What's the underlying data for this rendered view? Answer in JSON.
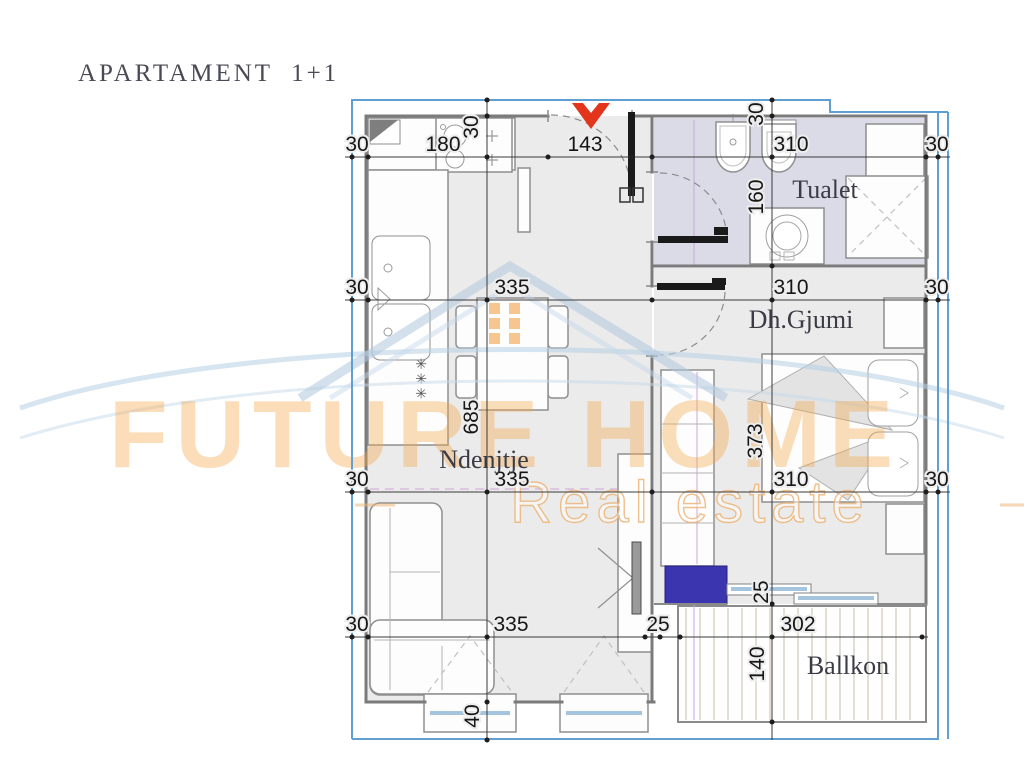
{
  "title": "APARTAMENT  1+1",
  "rooms": {
    "living": "Ndenjtje",
    "toilet": "Tualet",
    "bedroom": "Dh.Gjumi",
    "balcony": "Ballkon"
  },
  "watermark": {
    "brand_line1": "FUTURE HOME",
    "brand_line2": "Real estate"
  },
  "symbols": {
    "radiator": "✳✳✳"
  },
  "dims": {
    "r1_left": "30",
    "r1_kitchen": "180",
    "r1_entry": "143",
    "r1_toilet": "310",
    "r1_right": "30",
    "v_top_left": "30",
    "v_top_right": "30",
    "r2_left": "30",
    "r2_living": "335",
    "r2_bedroom": "310",
    "r2_right": "30",
    "toilet_depth": "160",
    "r3_left": "30",
    "r3_living": "335",
    "r3_bedroom": "310",
    "r3_right": "30",
    "living_depth": "685",
    "bedroom_depth": "373",
    "r4_left": "30",
    "r4_living": "335",
    "r4_door": "25",
    "r4_balcony": "302",
    "v_balcony_door": "25",
    "balcony_depth": "140",
    "window_depth": "40"
  },
  "colors": {
    "boundary_blue": "#5f9fd2",
    "toilet_floor": "#dbdae7",
    "balcony_deck": "#dcd4c1",
    "entrance_arrow_red": "#e2351b",
    "furniture_navy": "#3b35b0",
    "watermark_orange": "#f5a849"
  }
}
